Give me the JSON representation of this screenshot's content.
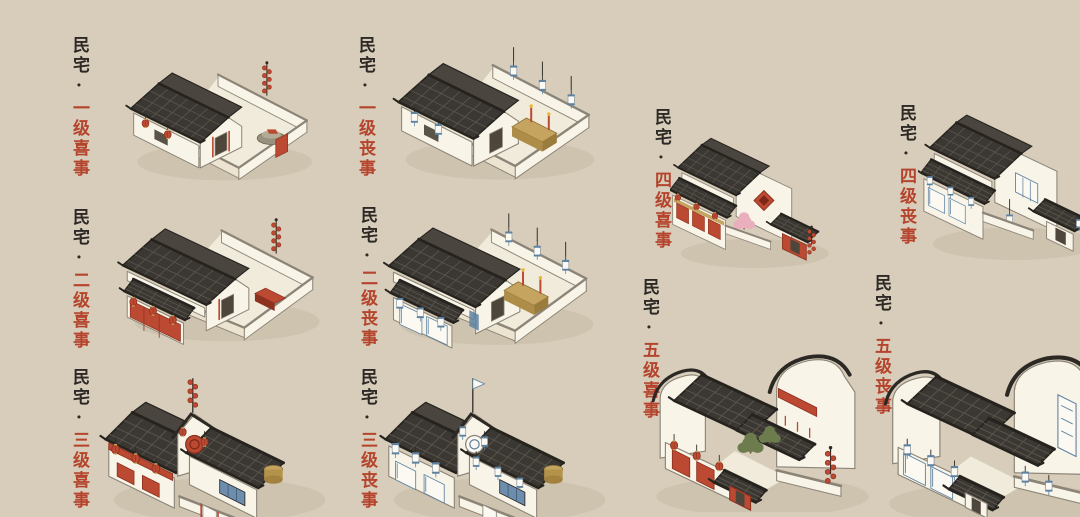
{
  "page": {
    "background": "#d7cdba"
  },
  "label": {
    "ink_color": "#2d2925",
    "accent_color": "#b5442d"
  },
  "house_palette": {
    "roof": "#3b3834",
    "roof_light": "#4a463f",
    "roof_line": "#5c574d",
    "roof_edge": "#26231f",
    "wall": "#f8f4e8",
    "wall_shade": "#ece4d1",
    "outline": "#8b8477",
    "ink": "#2c2925",
    "red": "#bc4931",
    "red_dark": "#8e3220",
    "blue": "#5e82a2",
    "wood": "#c4a45f",
    "paper": "#fbf9f1",
    "ground": "#c7bca6",
    "floor": "#f1ebdb",
    "stone": "#98917f",
    "pink": "#e9afbc",
    "green": "#6d7c4c",
    "opening": "#4e453b"
  },
  "items": [
    {
      "id": "residence-joy-1",
      "prefix": "民宅·",
      "level_label": "一级喜事",
      "level": 1,
      "theme": "joy"
    },
    {
      "id": "residence-mourning-1",
      "prefix": "民宅·",
      "level_label": "一级丧事",
      "level": 1,
      "theme": "mourning"
    },
    {
      "id": "residence-joy-2",
      "prefix": "民宅·",
      "level_label": "二级喜事",
      "level": 2,
      "theme": "joy"
    },
    {
      "id": "residence-mourning-2",
      "prefix": "民宅·",
      "level_label": "二级丧事",
      "level": 2,
      "theme": "mourning"
    },
    {
      "id": "residence-joy-3",
      "prefix": "民宅·",
      "level_label": "三级喜事",
      "level": 3,
      "theme": "joy"
    },
    {
      "id": "residence-mourning-3",
      "prefix": "民宅·",
      "level_label": "三级丧事",
      "level": 3,
      "theme": "mourning"
    },
    {
      "id": "residence-joy-4",
      "prefix": "民宅·",
      "level_label": "四级喜事",
      "level": 4,
      "theme": "joy"
    },
    {
      "id": "residence-mourning-4",
      "prefix": "民宅·",
      "level_label": "四级丧事",
      "level": 4,
      "theme": "mourning"
    },
    {
      "id": "residence-joy-5",
      "prefix": "民宅·",
      "level_label": "五级喜事",
      "level": 5,
      "theme": "joy"
    },
    {
      "id": "residence-mourning-5",
      "prefix": "民宅·",
      "level_label": "五级丧事",
      "level": 5,
      "theme": "mourning"
    }
  ]
}
